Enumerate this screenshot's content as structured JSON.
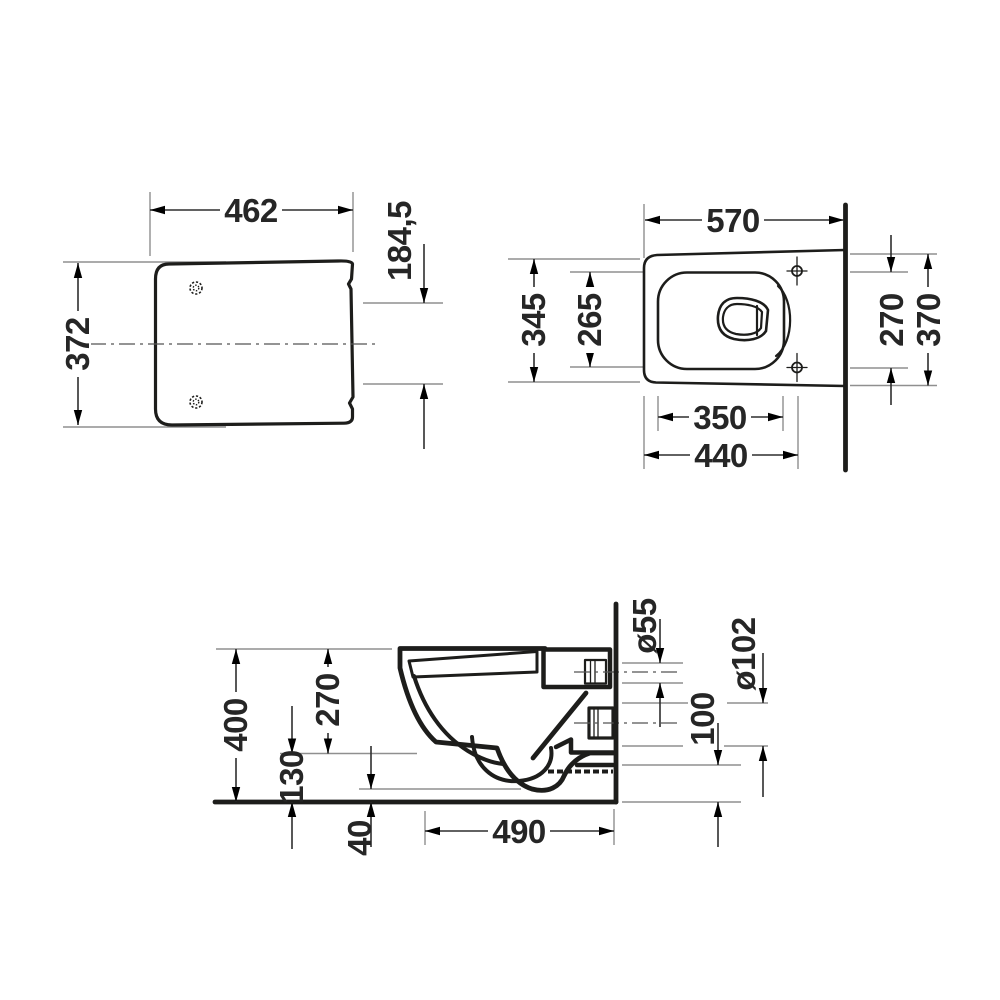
{
  "drawing": {
    "type": "technical-dimension-drawing",
    "subject": "wall-hung-toilet",
    "background": "#ffffff",
    "colors": {
      "outline": "#1d1d1b",
      "dimension_line": "#2e2e2e",
      "extension_line": "#8f8f8f",
      "centerline": "#555555",
      "text": "#262626"
    },
    "views": {
      "seat_top": {
        "title": "seat-lid-top-view",
        "dims": {
          "width": "462",
          "depth": "372",
          "offset": "184,5"
        }
      },
      "bowl_top": {
        "title": "bowl-top-view",
        "dims": {
          "depth": "570",
          "outer_width": "345",
          "inner_width": "265",
          "hole_spacing": "270",
          "rear_width": "370",
          "basin_length": "350",
          "fixing_length": "440"
        }
      },
      "side_section": {
        "title": "side-section-view",
        "dims": {
          "height": "400",
          "rim_drop": "270",
          "ledge_height": "130",
          "gap": "40",
          "length": "490",
          "inlet": "ø55",
          "outlet": "ø102",
          "offset": "100"
        }
      }
    }
  }
}
